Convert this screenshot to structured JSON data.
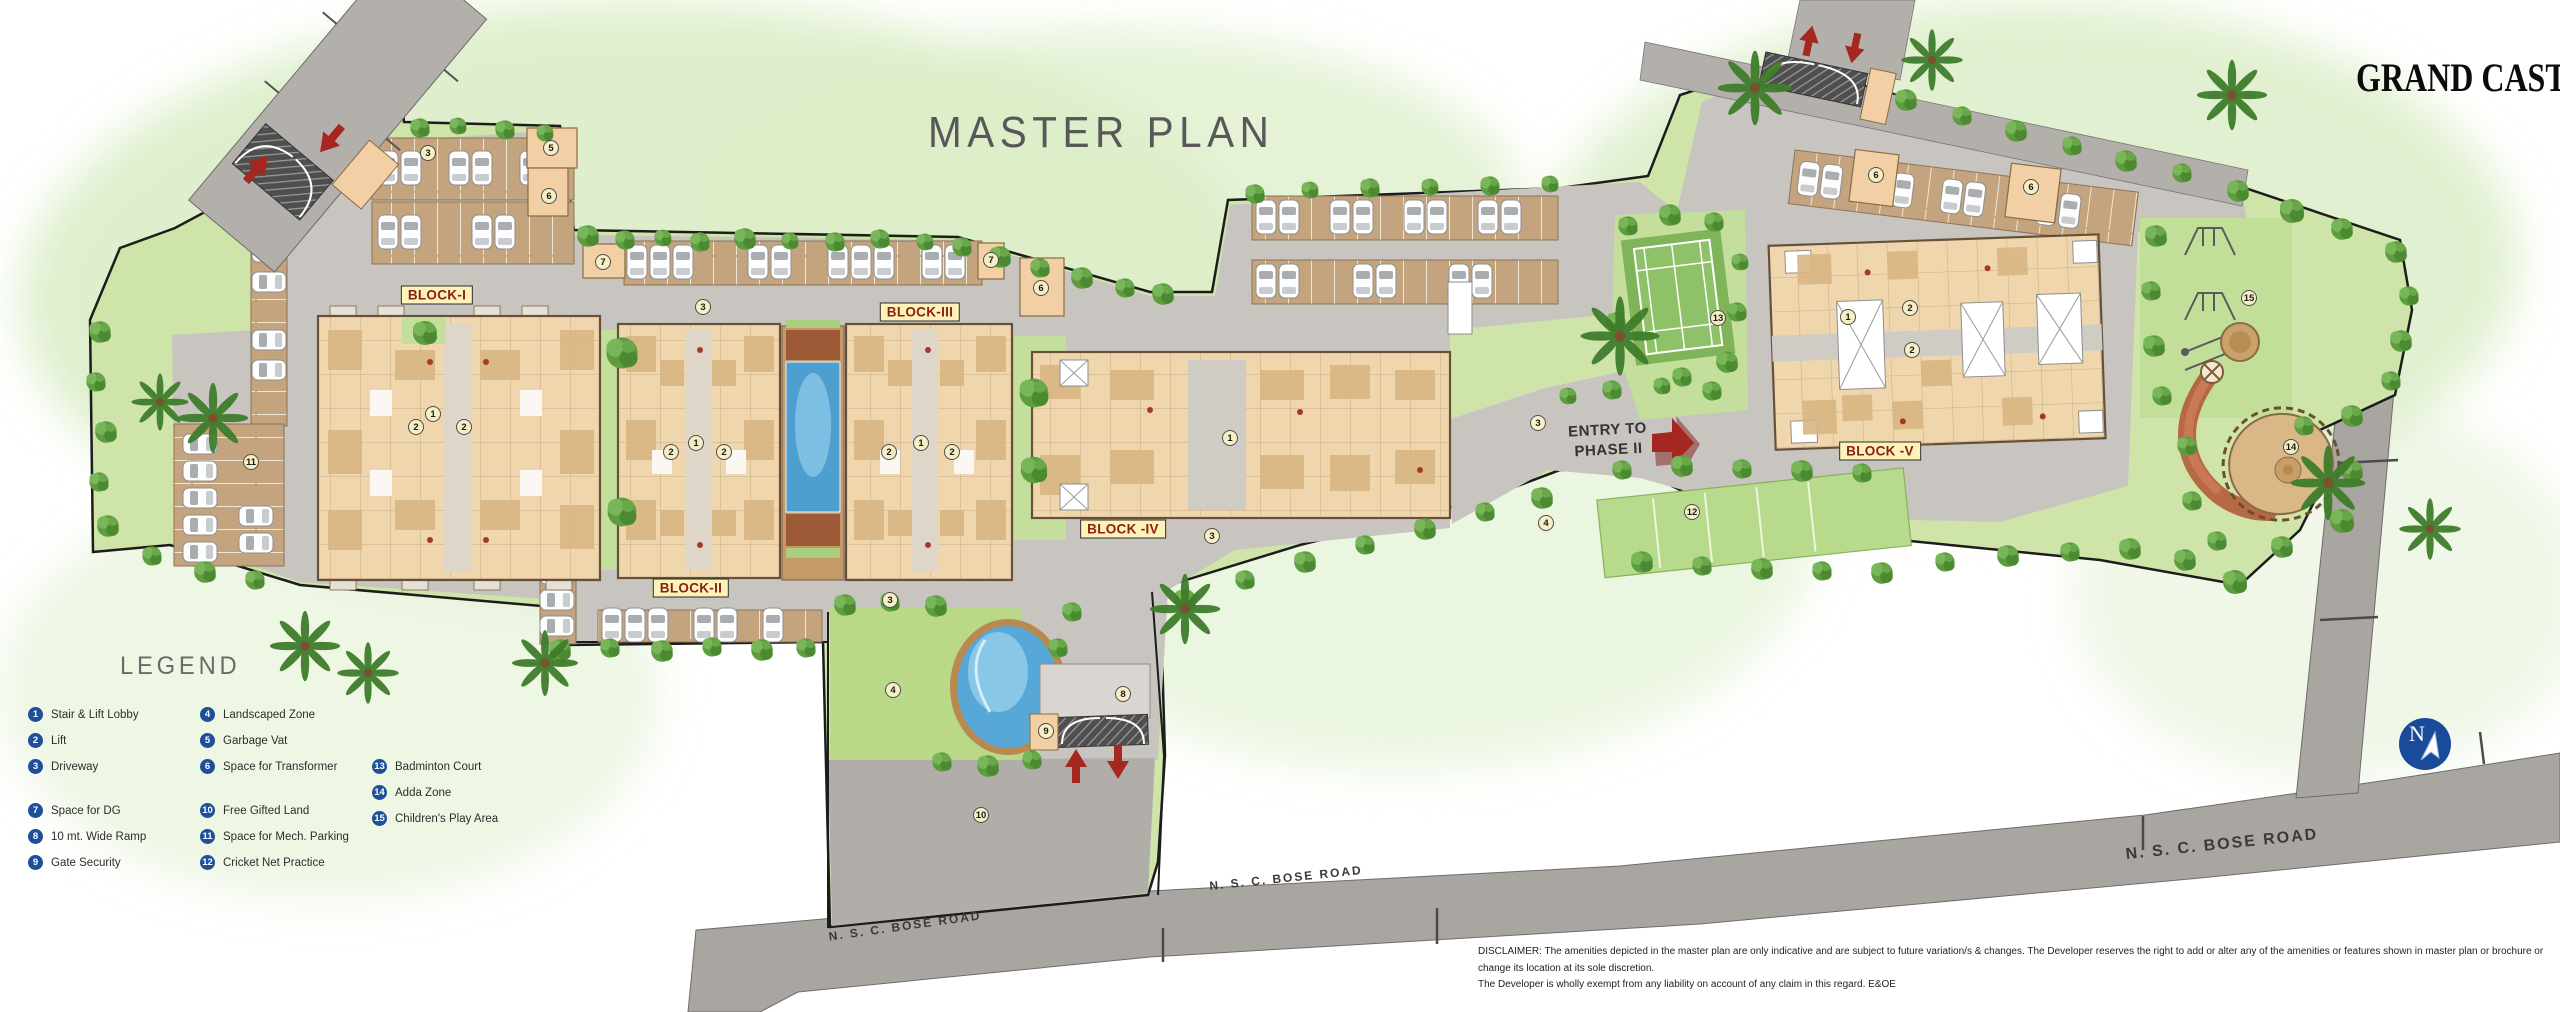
{
  "header": {
    "title": "MASTER PLAN",
    "brand": "GRAND CASTLE"
  },
  "legend": {
    "heading": "LEGEND",
    "columns": [
      {
        "items": [
          {
            "n": "1",
            "label": "Stair & Lift Lobby"
          },
          {
            "n": "2",
            "label": "Lift"
          },
          {
            "n": "3",
            "label": "Driveway"
          },
          {
            "n": "7",
            "label": "Space for DG",
            "gap": true
          },
          {
            "n": "8",
            "label": "10 mt. Wide Ramp"
          },
          {
            "n": "9",
            "label": "Gate Security"
          }
        ]
      },
      {
        "items": [
          {
            "n": "4",
            "label": "Landscaped Zone"
          },
          {
            "n": "5",
            "label": "Garbage Vat"
          },
          {
            "n": "6",
            "label": "Space for Transformer"
          },
          {
            "n": "10",
            "label": "Free Gifted Land",
            "gap": true
          },
          {
            "n": "11",
            "label": "Space for Mech. Parking"
          },
          {
            "n": "12",
            "label": "Cricket Net Practice"
          }
        ]
      },
      {
        "items": [
          {
            "n": "13",
            "label": "Badminton Court"
          },
          {
            "n": "14",
            "label": "Adda Zone"
          },
          {
            "n": "15",
            "label": "Children's Play Area"
          }
        ]
      }
    ]
  },
  "map": {
    "blocks": [
      {
        "name": "BLOCK-I",
        "x": 437,
        "y": 295
      },
      {
        "name": "BLOCK-II",
        "x": 691,
        "y": 588
      },
      {
        "name": "BLOCK-III",
        "x": 920,
        "y": 312
      },
      {
        "name": "BLOCK -IV",
        "x": 1123,
        "y": 529
      },
      {
        "name": "BLOCK -V",
        "x": 1880,
        "y": 451
      }
    ],
    "markers": [
      {
        "n": "3",
        "x": 428,
        "y": 153
      },
      {
        "n": "5",
        "x": 551,
        "y": 148
      },
      {
        "n": "6",
        "x": 549,
        "y": 196
      },
      {
        "n": "7",
        "x": 603,
        "y": 262
      },
      {
        "n": "3",
        "x": 703,
        "y": 307
      },
      {
        "n": "7",
        "x": 991,
        "y": 260
      },
      {
        "n": "6",
        "x": 1041,
        "y": 288
      },
      {
        "n": "11",
        "x": 251,
        "y": 462
      },
      {
        "n": "2",
        "x": 416,
        "y": 427
      },
      {
        "n": "1",
        "x": 433,
        "y": 414
      },
      {
        "n": "2",
        "x": 464,
        "y": 427
      },
      {
        "n": "2",
        "x": 671,
        "y": 452
      },
      {
        "n": "1",
        "x": 696,
        "y": 443
      },
      {
        "n": "2",
        "x": 724,
        "y": 452
      },
      {
        "n": "2",
        "x": 889,
        "y": 452
      },
      {
        "n": "1",
        "x": 921,
        "y": 443
      },
      {
        "n": "2",
        "x": 952,
        "y": 452
      },
      {
        "n": "1",
        "x": 1230,
        "y": 438
      },
      {
        "n": "3",
        "x": 1212,
        "y": 536
      },
      {
        "n": "3",
        "x": 890,
        "y": 600
      },
      {
        "n": "4",
        "x": 893,
        "y": 690
      },
      {
        "n": "10",
        "x": 981,
        "y": 815
      },
      {
        "n": "8",
        "x": 1123,
        "y": 694
      },
      {
        "n": "9",
        "x": 1046,
        "y": 731
      },
      {
        "n": "4",
        "x": 1546,
        "y": 523
      },
      {
        "n": "3",
        "x": 1538,
        "y": 423
      },
      {
        "n": "12",
        "x": 1692,
        "y": 512
      },
      {
        "n": "13",
        "x": 1718,
        "y": 318
      },
      {
        "n": "1",
        "x": 1848,
        "y": 317
      },
      {
        "n": "2",
        "x": 1910,
        "y": 308
      },
      {
        "n": "2",
        "x": 1912,
        "y": 350
      },
      {
        "n": "6",
        "x": 1876,
        "y": 175
      },
      {
        "n": "6",
        "x": 2031,
        "y": 187
      },
      {
        "n": "15",
        "x": 2249,
        "y": 298
      },
      {
        "n": "14",
        "x": 2291,
        "y": 447
      }
    ],
    "entry_phase2": {
      "line1": "ENTRY TO",
      "line2": "PHASE II"
    },
    "road_labels": [
      {
        "text": "N. S. C. BOSE ROAD",
        "x": 905,
        "y": 926,
        "rot": -8,
        "size": 12
      },
      {
        "text": "N. S. C. BOSE ROAD",
        "x": 1286,
        "y": 878,
        "rot": -6,
        "size": 12
      },
      {
        "text": "N. S. C. BOSE ROAD",
        "x": 2222,
        "y": 845,
        "rot": -6,
        "size": 16
      }
    ],
    "north_letter": "N"
  },
  "footer": {
    "disclaimer_line1": "DISCLAIMER: The amenities depicted in the master plan are only indicative and are subject to future variation/s & changes. The Developer reserves the right to add or alter any of the amenities or features shown in master plan or brochure or change its location at its sole discretion.",
    "disclaimer_line2": "The Developer is wholly exempt from any liability on account of any claim in this regard. E&OE"
  },
  "colors": {
    "legend_badge": "#1d4f9c",
    "marker_bg": "#f6eec4",
    "block_label_bg": "#fdf3b8",
    "block_label_text": "#8c1f15",
    "arrow_red": "#a5271f",
    "north_blue": "#1a4b9b",
    "site_green": "#cfe4a8",
    "drive_gray": "#c8c5c0",
    "road_gray": "#a9a6a2",
    "pool_blue": "#4e9fd0"
  }
}
